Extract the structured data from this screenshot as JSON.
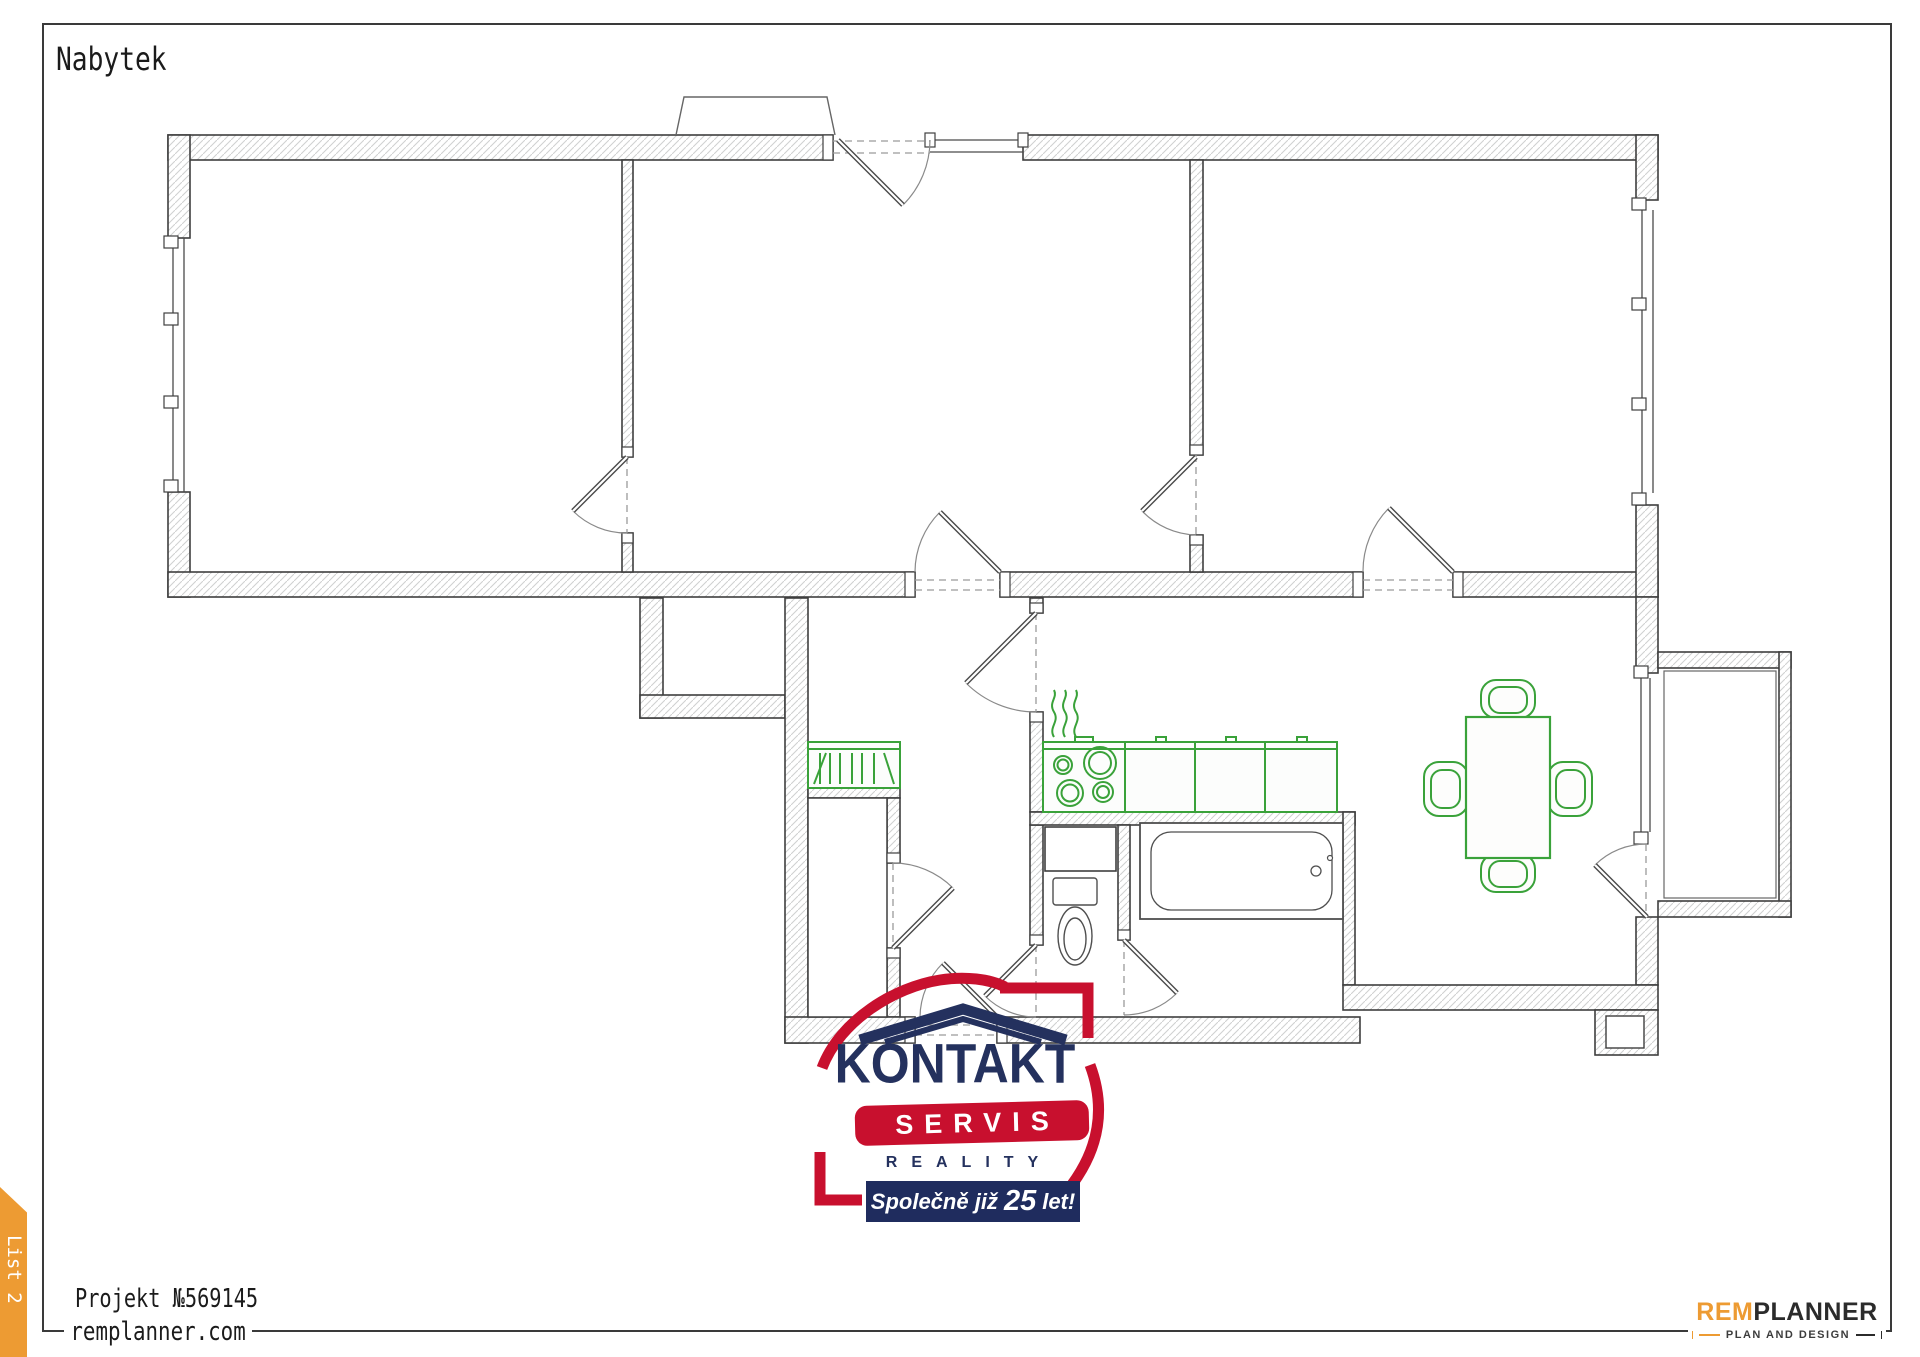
{
  "sheet": {
    "title": "Nabytek",
    "tab_label": "List 2"
  },
  "footer": {
    "project": "Projekt №569145",
    "website": "remplanner.com"
  },
  "branding": {
    "name_prefix": "REM",
    "name_suffix": "PLANNER",
    "tagline": "PLAN AND DESIGN",
    "accent_orange": "#ED9B33",
    "dark": "#2B2B2B"
  },
  "watermark": {
    "title": "KONTAKT",
    "subtitle": "SERVIS",
    "category": "REALITY",
    "banner_prefix": "Společně již",
    "banner_number": "25",
    "banner_suffix": "let!",
    "red": "#C8102E",
    "navy": "#1F2C5E"
  },
  "floorplan": {
    "wall_outline_color": "#3F3F3F",
    "wall_hatch_color": "#CFCFCF",
    "furniture_color": "#3AA23A",
    "fixture_color": "#4F4F4F",
    "door_arc_color": "#8A8A8A"
  }
}
